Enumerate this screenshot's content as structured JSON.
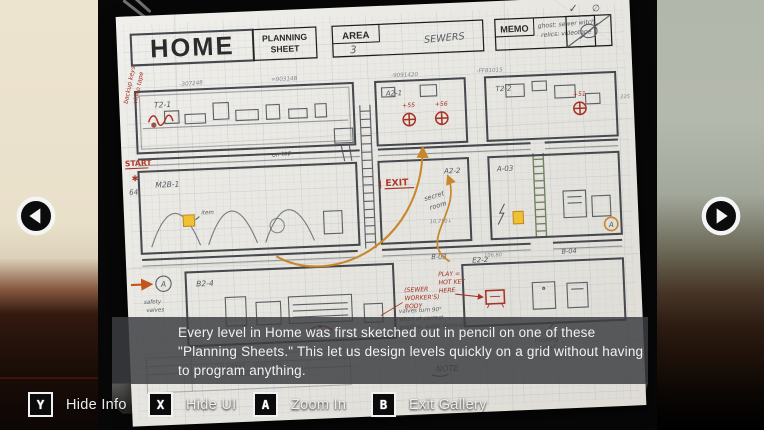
{
  "gallery": {
    "caption": "Every level in Home was first sketched out in pencil on one of these \"Planning Sheets.\" This let us design levels quickly on a grid without having to program anything.",
    "buttons": [
      {
        "key": "Y",
        "label": "Hide Info"
      },
      {
        "key": "X",
        "label": "Hide UI"
      },
      {
        "key": "A",
        "label": "Zoom In"
      },
      {
        "key": "B",
        "label": "Exit Gallery"
      }
    ]
  },
  "sheet": {
    "logo": "HOME",
    "subtitle": {
      "line1": "PLANNING",
      "line2": "SHEET"
    },
    "area": {
      "label": "AREA",
      "value": "3",
      "name": "SEWERS"
    },
    "memo": {
      "label": "MEMO",
      "line1": "ghost: sewer witch",
      "line2": "relics: videotape"
    },
    "corner": {
      "check": "✓",
      "empty": "∅"
    },
    "margin": {
      "note1": "backup keys",
      "note2": "video tape",
      "start": "START",
      "star": "✱",
      "num": "64"
    },
    "rooms": {
      "r1": "T2-1",
      "r2": "A2-1",
      "r3": "T2-2",
      "r4": "M2B-1",
      "r5": "A2-2",
      "r6": "A-03",
      "r7": "B2-4",
      "r8": "E2-2",
      "r9": "B-03",
      "r10": "B-04"
    },
    "valves": {
      "v1": "+55",
      "v2": "+56",
      "v3": "+51"
    },
    "notes": {
      "on_top": "on top",
      "exit": "EXIT",
      "secret1": "secret",
      "secret2": "room",
      "valve1": "valves turn 90°",
      "valve2": "when at correct",
      "valve3": "position, water turns off",
      "nums1": "10,750↓",
      "nums2": "106,80",
      "safety1": "safety",
      "safety2": "valves",
      "body1": "(SEWER",
      "body2": "WORKER'S)",
      "body3": "BODY",
      "play1": "PLAY =",
      "play2": "HOT KEY",
      "play3": "HERE",
      "missing1": "missing",
      "missing2": "tape?",
      "item": "item",
      "tape": "FLAMMAB — VIDEO TAPE",
      "desc": "LEVEL DESCRIPTION",
      "note": "NOTE"
    },
    "scribbles": {
      "a": "-307248",
      "b": "=90314B",
      "c": "-9091420",
      "d": "-FF81015",
      "e": "225"
    }
  },
  "colors": {
    "red_ink": "#a33226",
    "orange_marker": "#c8872b",
    "highlight_yellow": "#efc133",
    "pencil": "#5d6166",
    "paper": "#e9e7e2",
    "caption_bg": "#3c4044"
  }
}
